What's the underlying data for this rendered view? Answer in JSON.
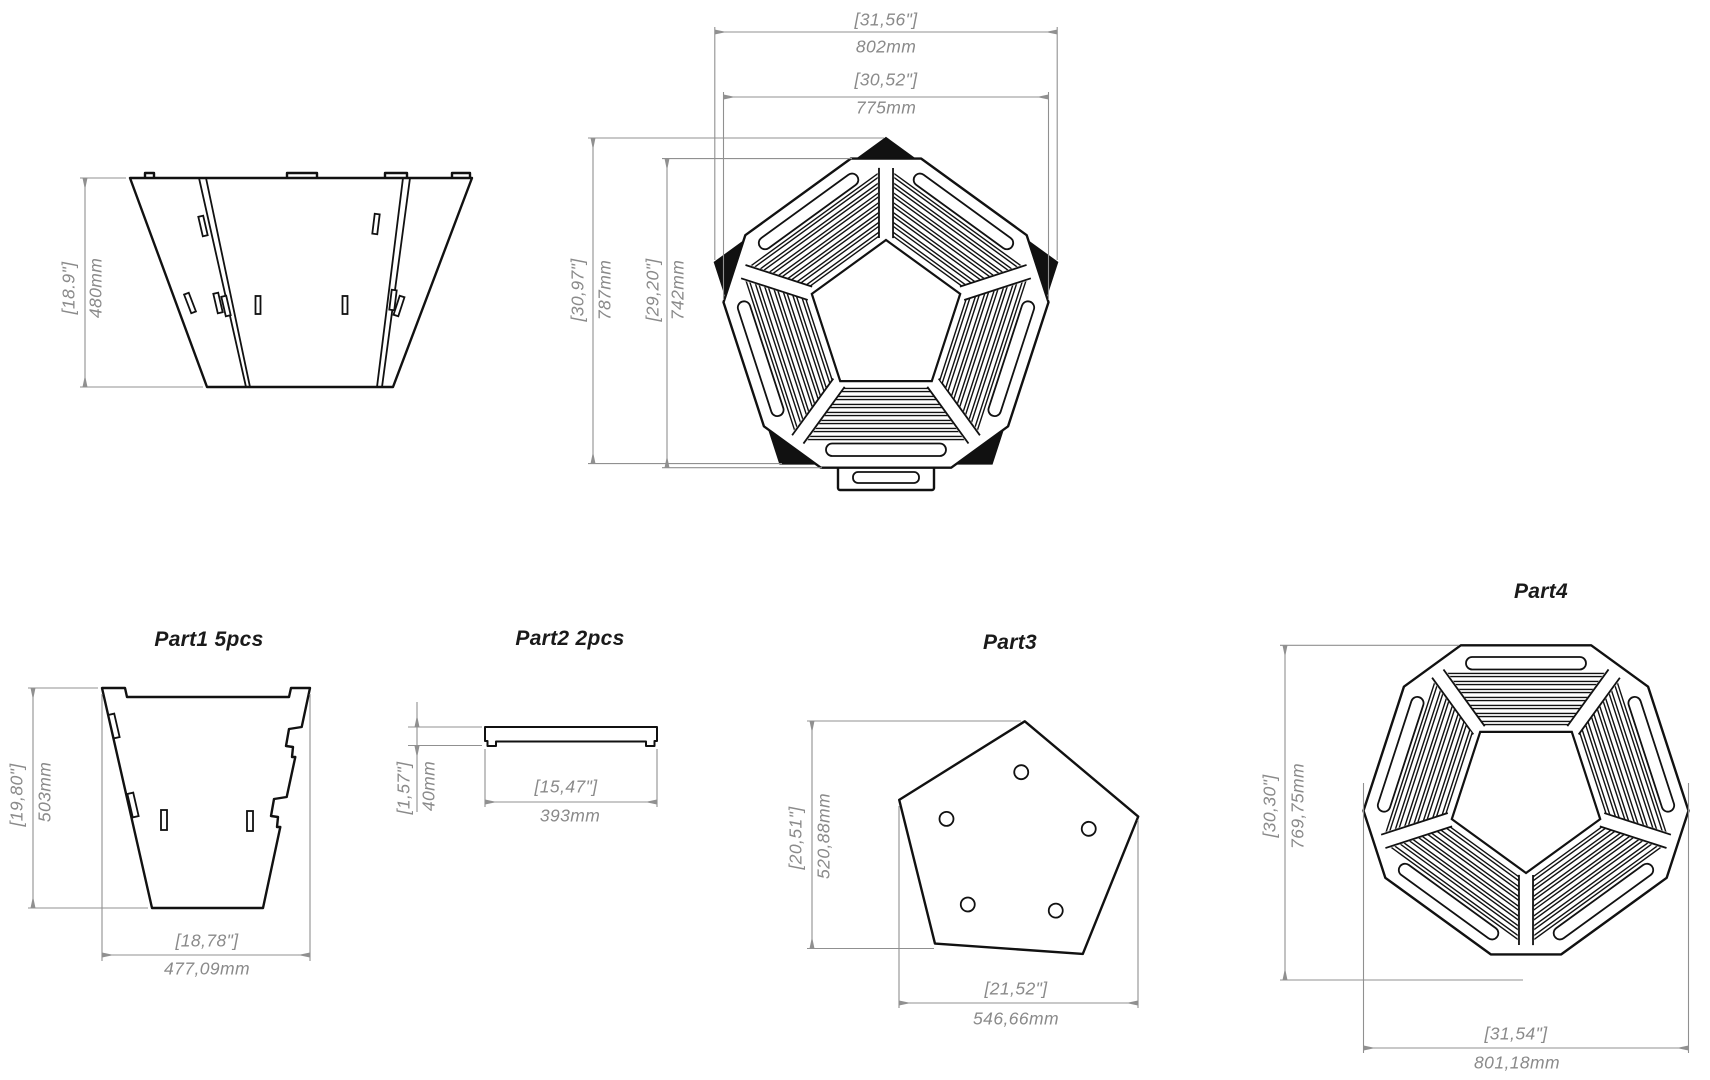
{
  "meta": {
    "background": "#ffffff",
    "line_color": "#111111",
    "dimension_color": "#8a8a8a"
  },
  "assembled": {
    "side_view": {
      "height": {
        "inch": "[18.9\"]",
        "mm": "480mm"
      }
    },
    "top_view": {
      "outer_width": {
        "inch": "[31,56\"]",
        "mm": "802mm"
      },
      "inner_width": {
        "inch": "[30,52\"]",
        "mm": "775mm"
      },
      "outer_height": {
        "inch": "[30,97\"]",
        "mm": "787mm"
      },
      "inner_height": {
        "inch": "[29,20\"]",
        "mm": "742mm"
      }
    }
  },
  "parts": {
    "part1": {
      "label": "Part1 5pcs",
      "height": {
        "inch": "[19,80\"]",
        "mm": "503mm"
      },
      "width": {
        "inch": "[18,78\"]",
        "mm": "477,09mm"
      }
    },
    "part2": {
      "label": "Part2 2pcs",
      "height": {
        "inch": "[1,57\"]",
        "mm": "40mm"
      },
      "width": {
        "inch": "[15,47\"]",
        "mm": "393mm"
      }
    },
    "part3": {
      "label": "Part3",
      "height": {
        "inch": "[20,51\"]",
        "mm": "520,88mm"
      },
      "width": {
        "inch": "[21,52\"]",
        "mm": "546,66mm"
      }
    },
    "part4": {
      "label": "Part4",
      "height": {
        "inch": "[30,30\"]",
        "mm": "769,75mm"
      },
      "width": {
        "inch": "[31,54\"]",
        "mm": "801,18mm"
      }
    }
  }
}
